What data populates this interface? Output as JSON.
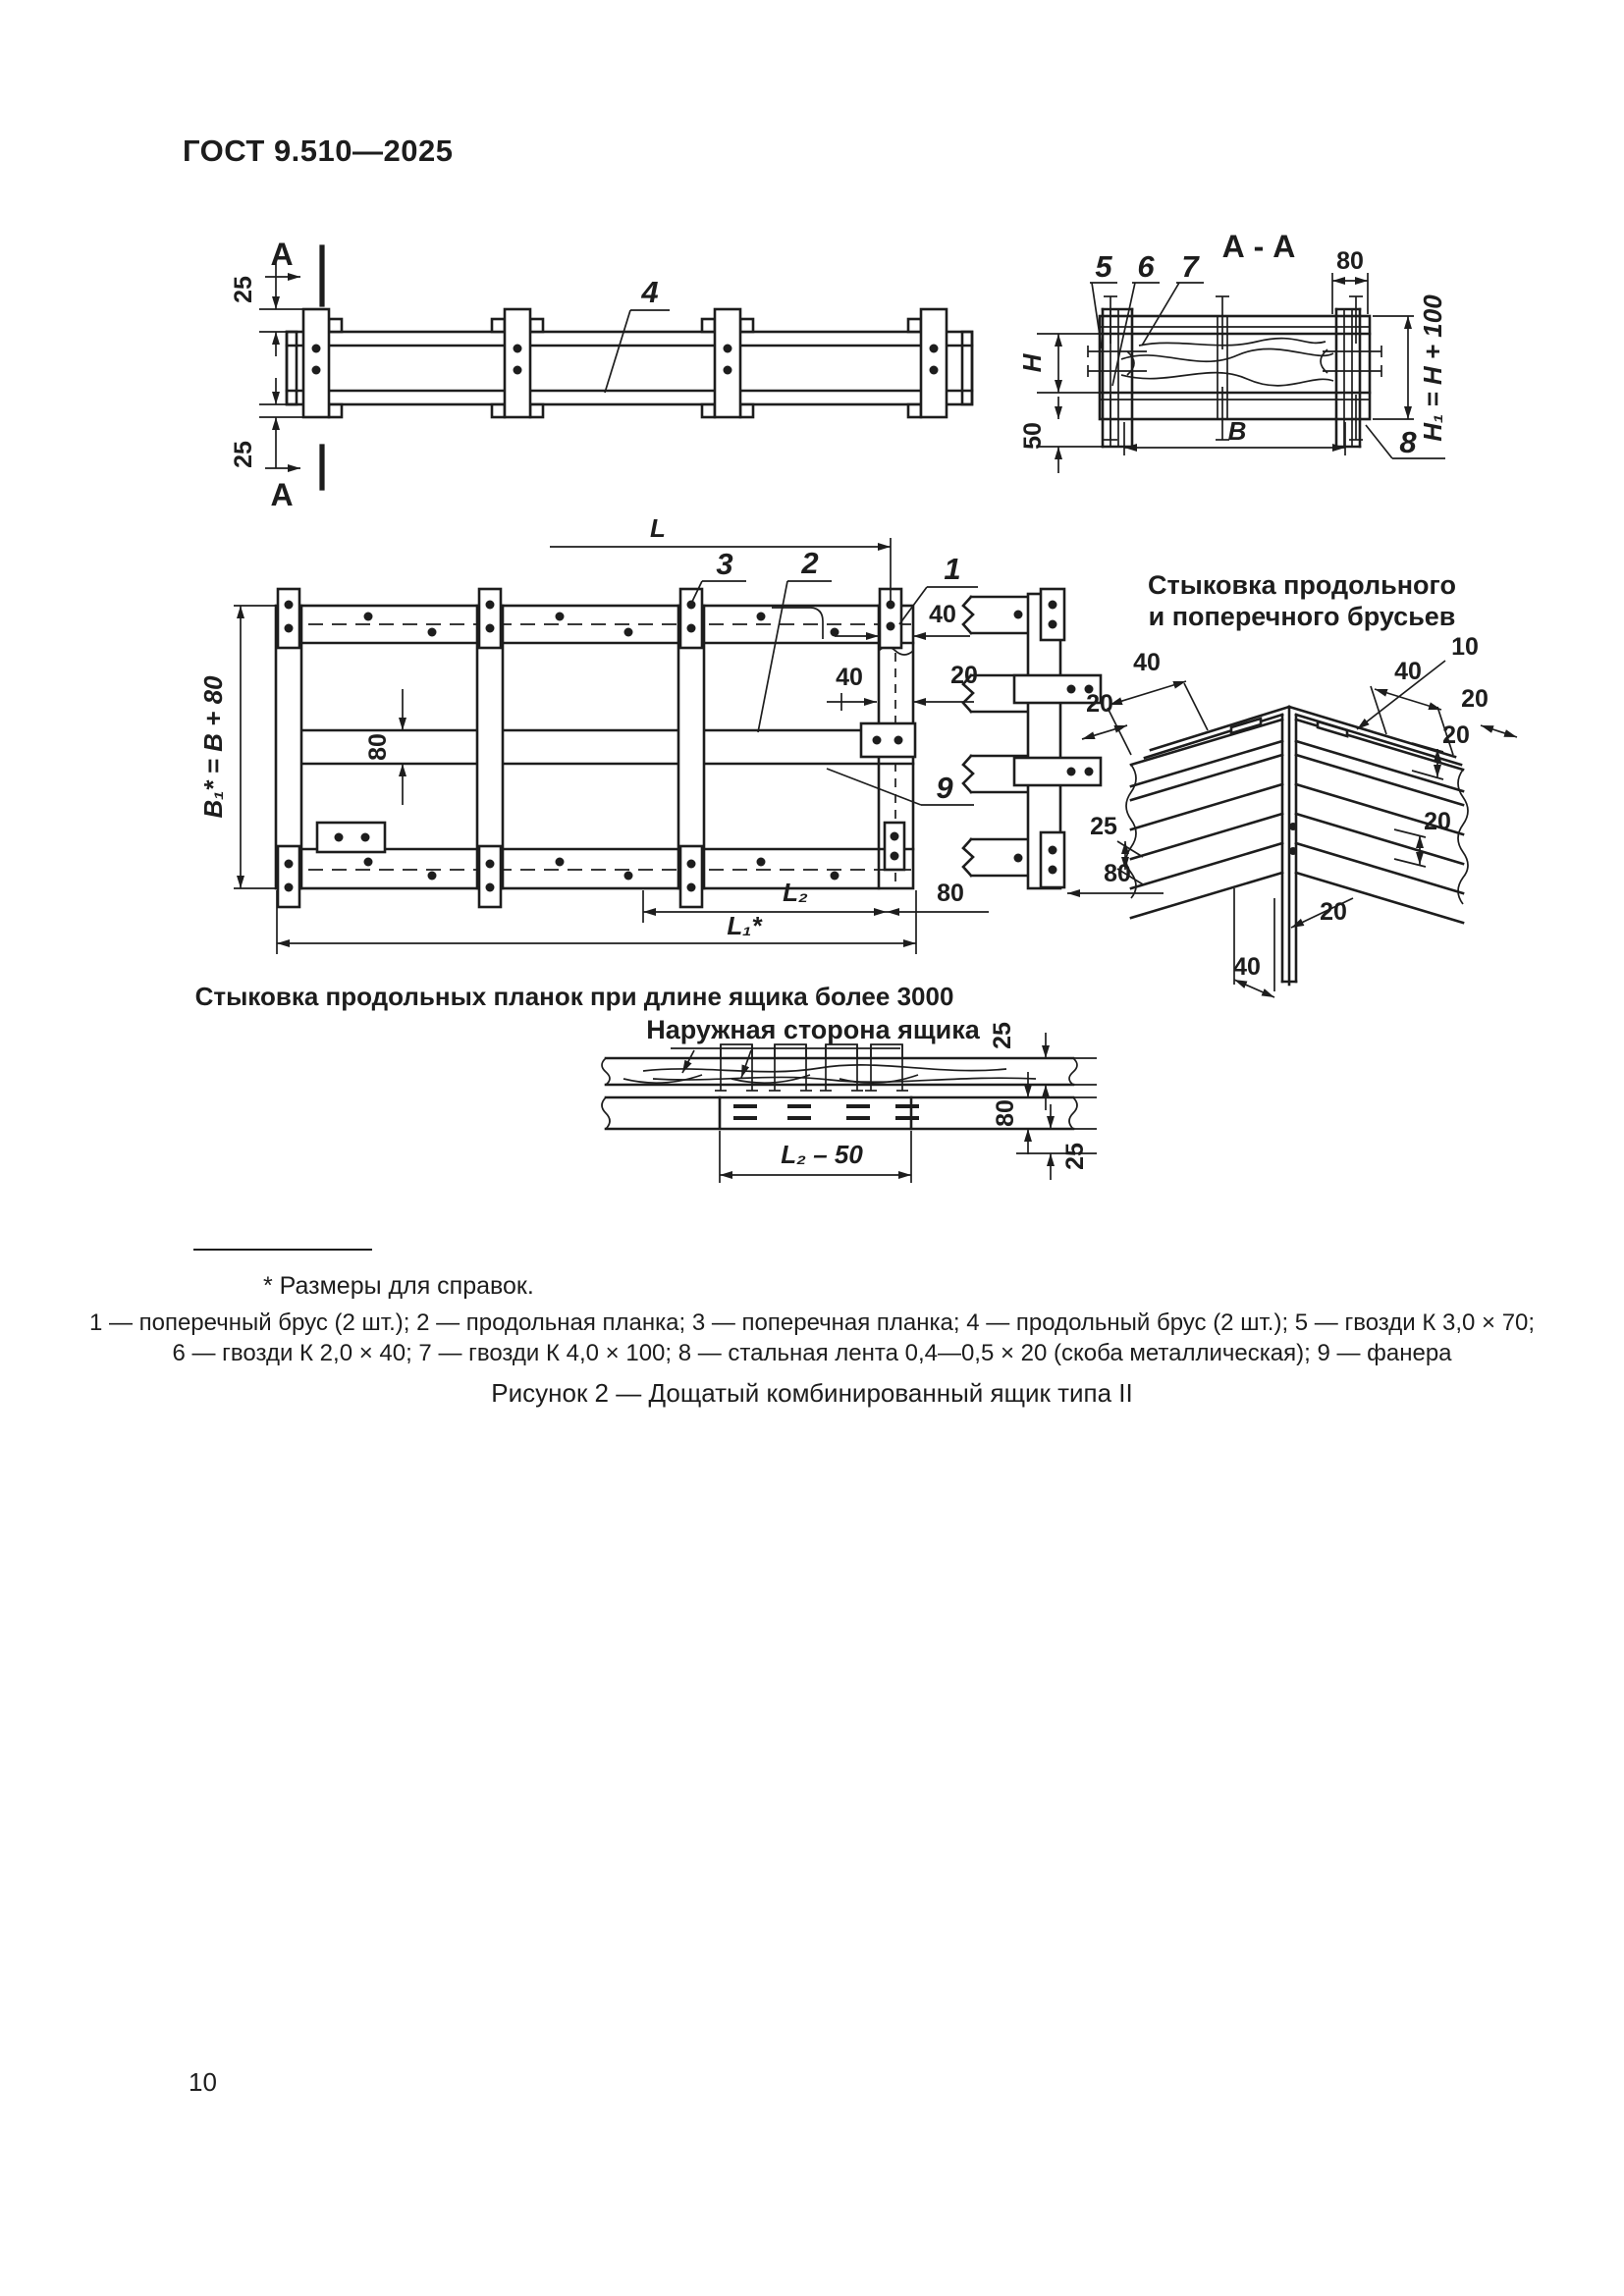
{
  "page": {
    "header": "ГОСТ 9.510—2025",
    "page_number": "10",
    "footnote": "* Размеры для справок.",
    "legend_line1": "1 — поперечный брус (2 шт.); 2 — продольная планка; 3 — поперечная планка; 4 — продольный брус (2 шт.); 5 — гвозди К 3,0 × 70;",
    "legend_line2": "6 — гвозди К 2,0 × 40; 7 — гвозди К 4,0 × 100; 8 — стальная лента 0,4—0,5 × 20 (скоба металлическая); 9 — фанера",
    "figure_caption": "Рисунок 2 — Дощатый комбинированный ящик типа II"
  },
  "beam_view": {
    "section_letter_top": "А",
    "section_letter_bottom": "А",
    "dim_25_top": "25",
    "dim_25_bottom": "25",
    "part_4": "4"
  },
  "section_aa": {
    "title": "А - А",
    "part_5": "5",
    "part_6": "6",
    "part_7": "7",
    "part_8": "8",
    "dim_80": "80",
    "dim_h": "H",
    "dim_50": "50",
    "dim_b": "В",
    "dim_h1": "H₁ = H + 100"
  },
  "plan_view": {
    "dim_l": "L",
    "part_1": "1",
    "part_2": "2",
    "part_3": "3",
    "part_9": "9",
    "dim_40_end": "40",
    "dim_40_joint": "40",
    "dim_20_joint": "20",
    "dim_80_mid": "80",
    "dim_b1": "B₁* = B + 80",
    "dim_l1": "L₁*",
    "dim_l2": "L₂",
    "dim_80_right": "80",
    "caption": "Стыковка продольных планок при длине ящика более 3000"
  },
  "strip_view": {
    "dim_80": "80"
  },
  "corner_detail": {
    "title_line1": "Стыковка продольного",
    "title_line2": "и поперечного брусьев",
    "dim_40_left": "40",
    "dim_20_left": "20",
    "dim_40_right": "40",
    "dim_10_right": "10",
    "dim_20_right_top": "20",
    "dim_20_right_mid": "20",
    "dim_20_right_low": "20",
    "dim_25_left": "25",
    "dim_20_bottom": "20",
    "dim_40_bottom": "40"
  },
  "outer_detail": {
    "title": "Наружная сторона ящика",
    "dim_25_top": "25",
    "dim_80": "80",
    "dim_25_bottom": "25",
    "dim_l2_50": "L₂ – 50"
  }
}
